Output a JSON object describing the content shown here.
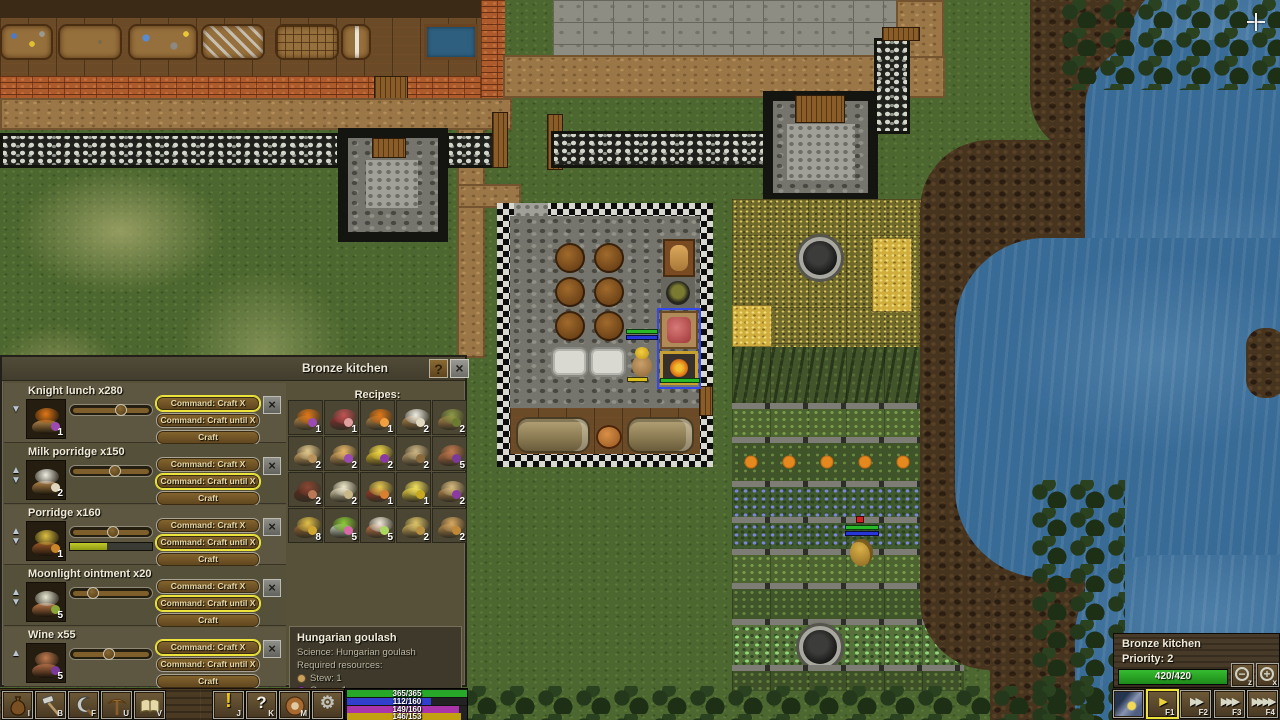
{
  "window": {
    "title": "Bronze kitchen",
    "help_label": "?",
    "close_label": "×"
  },
  "queue": {
    "buttons": [
      "Command: Craft X",
      "Command: Craft until X",
      "Craft"
    ],
    "rows": [
      {
        "name": "Knight lunch x280",
        "count": "1",
        "arrows": [
          "down"
        ],
        "slider_pct": 62,
        "progress_pct": null,
        "active_button": 0,
        "icon": {
          "bowl": "#b5874a",
          "fill": "#e07818",
          "accent": "#9a4ab0"
        }
      },
      {
        "name": "Milk porridge x150",
        "count": "2",
        "arrows": [
          "up",
          "down"
        ],
        "slider_pct": 55,
        "progress_pct": null,
        "active_button": 1,
        "icon": {
          "bowl": "#b5874a",
          "fill": "#efede2",
          "accent": "#ddd5bd"
        }
      },
      {
        "name": "Porridge x160",
        "count": "1",
        "arrows": [
          "up",
          "down"
        ],
        "slider_pct": 52,
        "progress_pct": 45,
        "active_button": 1,
        "icon": {
          "bowl": "#a05a28",
          "fill": "#dcbf42",
          "accent": "#c8862a"
        }
      },
      {
        "name": "Moonlight ointment x20",
        "count": "5",
        "arrows": [
          "up",
          "down"
        ],
        "slider_pct": 28,
        "progress_pct": null,
        "active_button": 1,
        "icon": {
          "bowl": "#c07848",
          "fill": "#e9e9d5",
          "accent": "#8aa838"
        }
      },
      {
        "name": "Wine x55",
        "count": "5",
        "arrows": [
          "up"
        ],
        "slider_pct": 48,
        "progress_pct": null,
        "active_button": 0,
        "icon": {
          "bowl": "#b06a42",
          "fill": "#c07a4e",
          "accent": "#7a3a9a"
        }
      }
    ]
  },
  "recipes": {
    "header": "Recipes:",
    "items": [
      {
        "count": "1",
        "bowl": "#b5874a",
        "fill": "#e07818",
        "accent": "#9a4ab0"
      },
      {
        "count": "1",
        "bowl": "#8a3030",
        "fill": "#c05454",
        "accent": "#e0a0a0"
      },
      {
        "count": "1",
        "bowl": "#b5874a",
        "fill": "#e07818",
        "accent": "#f0a040"
      },
      {
        "count": "2",
        "bowl": "#b5874a",
        "fill": "#efede2",
        "accent": "#e0d8c0"
      },
      {
        "count": "2",
        "bowl": "#b5874a",
        "fill": "#8f9a48",
        "accent": "#6a7a30"
      },
      {
        "count": "2",
        "bowl": "#caa05c",
        "fill": "#e3c98e",
        "accent": "#b8925a"
      },
      {
        "count": "2",
        "bowl": "#c89858",
        "fill": "#e8b868",
        "accent": "#9a4ab0"
      },
      {
        "count": "2",
        "bowl": "#d8b828",
        "fill": "#f0d848",
        "accent": "#8a3aa0"
      },
      {
        "count": "2",
        "bowl": "#b59a6a",
        "fill": "#cdb584",
        "accent": "#8a6a3a"
      },
      {
        "count": "5",
        "bowl": "#b06a42",
        "fill": "#c07a4e",
        "accent": "#7a3a9a"
      },
      {
        "count": "2",
        "bowl": "#5a2a1e",
        "fill": "#8a4632",
        "accent": "#b87858"
      },
      {
        "count": "2",
        "bowl": "#d8cfae",
        "fill": "#efe8cb",
        "accent": "#c8b888"
      },
      {
        "count": "1",
        "bowl": "#a83828",
        "fill": "#e8c850",
        "accent": "#d88030"
      },
      {
        "count": "1",
        "bowl": "#e8d040",
        "fill": "#f2e05c",
        "accent": "#c8a820"
      },
      {
        "count": "2",
        "bowl": "#b5874a",
        "fill": "#d8bc80",
        "accent": "#8a3aa0"
      },
      {
        "count": "8",
        "bowl": "#9a6a34",
        "fill": "#e2c048",
        "accent": "#d0a830"
      },
      {
        "count": "5",
        "bowl": "#c8d8c8",
        "fill": "#8ac838",
        "accent": "#d868a8"
      },
      {
        "count": "5",
        "bowl": "#c87848",
        "fill": "#efe8d8",
        "accent": "#aad860"
      },
      {
        "count": "2",
        "bowl": "#c8a858",
        "fill": "#ddc468",
        "accent": "#b89040"
      },
      {
        "count": "2",
        "bowl": "#b5874a",
        "fill": "#d8a860",
        "accent": "#c08838"
      }
    ]
  },
  "tooltip": {
    "title": "Hungarian goulash",
    "science": "Science: Hungarian goulash",
    "required": "Required resources:",
    "resources": [
      {
        "color": "#caa05c",
        "name": "Stew: 1"
      },
      {
        "color": "#8a3aa0",
        "name": "Grape: 1"
      },
      {
        "color": "#9a6a34",
        "name": "Wooden bowl: 2"
      }
    ]
  },
  "toolbar": {
    "group1": [
      {
        "icon": "sack",
        "key": "I"
      },
      {
        "icon": "hammer",
        "key": "B"
      },
      {
        "icon": "sickle",
        "key": "F"
      },
      {
        "icon": "pickaxe",
        "key": "U"
      },
      {
        "icon": "book",
        "key": "V"
      }
    ],
    "group2": [
      {
        "icon": "exclamation",
        "key": "J"
      },
      {
        "icon": "question",
        "key": "K"
      },
      {
        "icon": "meal",
        "key": "M"
      },
      {
        "icon": "gear",
        "key": ""
      }
    ]
  },
  "status_bars": [
    {
      "value": "365/365",
      "pct": 100,
      "color": "#28a828"
    },
    {
      "value": "112/160",
      "pct": 70,
      "color": "#3040cc"
    },
    {
      "value": "149/160",
      "pct": 93,
      "color": "#aa35aa"
    },
    {
      "value": "146/153",
      "pct": 95,
      "color": "#c2a00f"
    }
  ],
  "workshop_panel": {
    "title": "Bronze kitchen",
    "priority_label": "Priority: 2",
    "gauge_value": "420/420",
    "gauge_pct": 100,
    "minus_glyph": "−",
    "plus_glyph": "+",
    "minus_key": "z",
    "plus_key": "x",
    "speed_buttons": [
      {
        "icon": "daynight",
        "label": "",
        "active": false
      },
      {
        "icon": "play1",
        "label": "F1",
        "active": true
      },
      {
        "icon": "play2",
        "label": "F2",
        "active": false
      },
      {
        "icon": "play3",
        "label": "F3",
        "active": false
      },
      {
        "icon": "play4",
        "label": "F4",
        "active": false
      }
    ]
  }
}
